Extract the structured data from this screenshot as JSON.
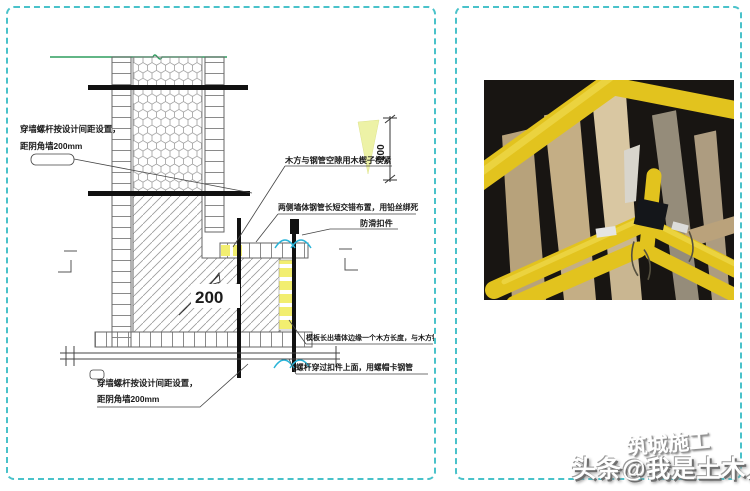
{
  "diagram": {
    "labels": {
      "tie_top": {
        "line1": "穿墙螺杆按设计间距设置，",
        "line2": "距阴角墙200mm"
      },
      "tie_bottom": {
        "line1": "穿墙螺杆按设计间距设置，",
        "line2": "距阴角墙200mm"
      },
      "wedge_note": "木方与钢管空隙用木楔子楔紧",
      "stagger_note": "两侧墙体钢管长短交错布置，用铅丝绑死",
      "antislip_note": "防滑扣件",
      "panel_extend_note": "模板长出墙体边缘一个木方长度，与木方钉在一起",
      "bolt_note": "螺杆穿过扣件上面，用螺帽卡钢管",
      "dim_side": "200",
      "dim_corner": "200"
    }
  },
  "watermark": {
    "overlay": "筑城施工",
    "main": "头条@我是土木人"
  },
  "colors": {
    "panel_border": "#49c2ca",
    "ground_line": "#2f9e5f",
    "wood_batten": "#f2ee70",
    "dim_triangle": "#edf2a6",
    "rotation_arc": "#2ab4d8",
    "scaffold_yellow": "#e2c31e"
  }
}
